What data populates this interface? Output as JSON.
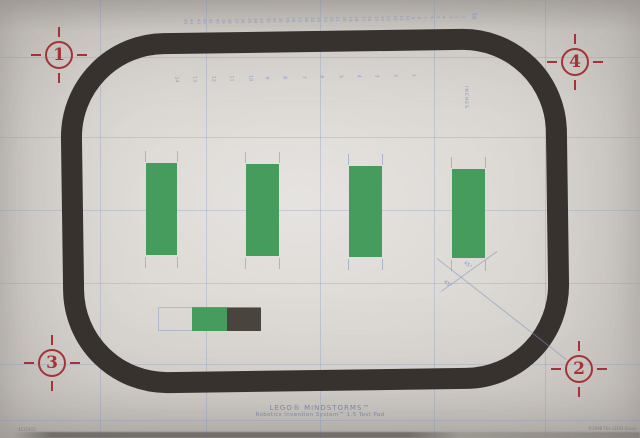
{
  "photo": {
    "title": {
      "line1": "LEGO® MINDSTORMS™",
      "line2": "Robotics Invention System™ 1.5 Test Pad"
    },
    "corner_markers": [
      {
        "label": "1",
        "x": 59,
        "y": 55
      },
      {
        "label": "4",
        "x": 575,
        "y": 62
      },
      {
        "label": "3",
        "x": 52,
        "y": 363
      },
      {
        "label": "2",
        "x": 579,
        "y": 369
      }
    ],
    "green_bars": [
      {
        "x": 146,
        "y": 163,
        "w": 31,
        "h": 92
      },
      {
        "x": 246,
        "y": 164,
        "w": 33,
        "h": 92
      },
      {
        "x": 349,
        "y": 166,
        "w": 33,
        "h": 91
      },
      {
        "x": 452,
        "y": 169,
        "w": 33,
        "h": 89
      }
    ],
    "rulers": {
      "top": {
        "y": 17,
        "x_start": 185,
        "step": 6.35,
        "values": [
          45,
          44,
          43,
          42,
          41,
          40,
          39,
          38,
          37,
          36,
          35,
          34,
          33,
          32,
          31,
          30,
          29,
          28,
          27,
          26,
          25,
          24,
          23,
          22,
          21,
          20,
          19,
          18,
          17,
          16,
          15,
          14,
          13,
          12,
          11,
          10,
          9,
          8,
          7,
          6,
          5,
          4,
          3,
          2,
          1
        ]
      },
      "inner": {
        "y": 74,
        "x_start": 175,
        "step": 18.4,
        "values": [
          14,
          13,
          12,
          11,
          10,
          9,
          8,
          7,
          6,
          5,
          4,
          3,
          2,
          1
        ]
      },
      "end_label": "50",
      "side_label": "INCHES"
    },
    "angle_labels": [
      {
        "text": "45°",
        "x": 466,
        "y": 260,
        "rot": 40
      },
      {
        "text": "45°",
        "x": 446,
        "y": 279,
        "rot": 40
      }
    ],
    "small_print": {
      "left": "4121915",
      "right": "©1998 The LEGO Group"
    },
    "colors": {
      "paper": "#d6d2cd",
      "track": "#38322e",
      "green": "#459c5c",
      "dark_block": "#4a443f",
      "red": "#a43338",
      "grid_blue": "#7d91c0",
      "title_text": "#7d87a3"
    }
  }
}
